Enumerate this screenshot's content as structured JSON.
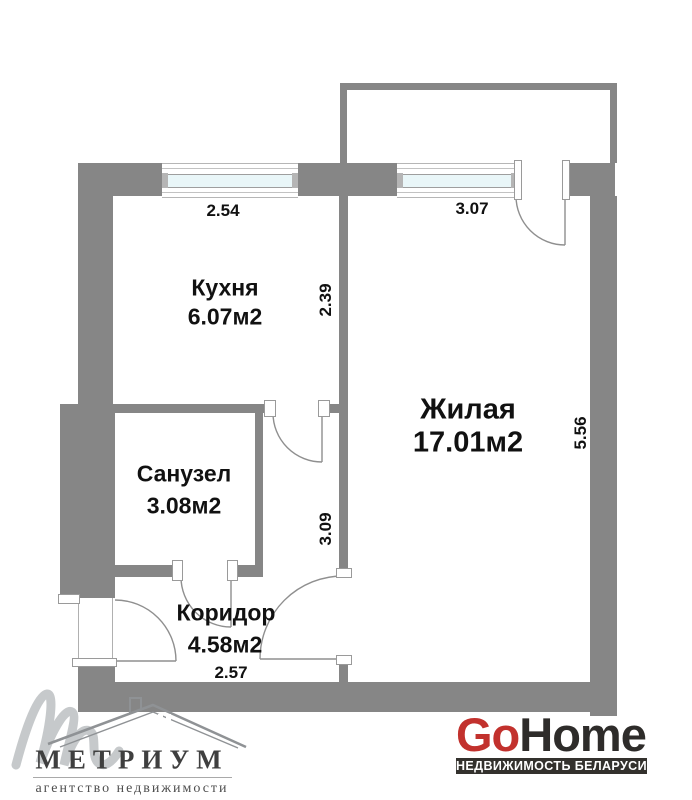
{
  "plan": {
    "rooms": {
      "kitchen": {
        "name": "Кухня",
        "area": "6.07м2"
      },
      "living": {
        "name": "Жилая",
        "area": "17.01м2"
      },
      "bathroom": {
        "name": "Санузел",
        "area": "3.08м2"
      },
      "corridor": {
        "name": "Коридор",
        "area": "4.58м2"
      }
    },
    "dimensions": {
      "kitchen_width": "2.54",
      "kitchen_depth": "2.39",
      "living_width": "3.07",
      "living_depth": "5.56",
      "hall_depth": "3.09",
      "corridor_width": "2.57"
    }
  },
  "branding": {
    "metrium": {
      "name": "МЕТРИУМ",
      "tagline": "агентство недвижимости"
    },
    "gohome": {
      "go": "Go",
      "home": "Home",
      "badge": "НЕДВИЖИМОСТЬ БЕЛАРУСИ"
    }
  },
  "colors": {
    "wall": "#868686",
    "window_glass": "#e9f6f8",
    "text": "#111111",
    "metrium_dark": "#3f3f3f",
    "gohome_red": "#c2312d",
    "gohome_dark": "#2e2c2a",
    "badge_bg": "#33312d"
  }
}
